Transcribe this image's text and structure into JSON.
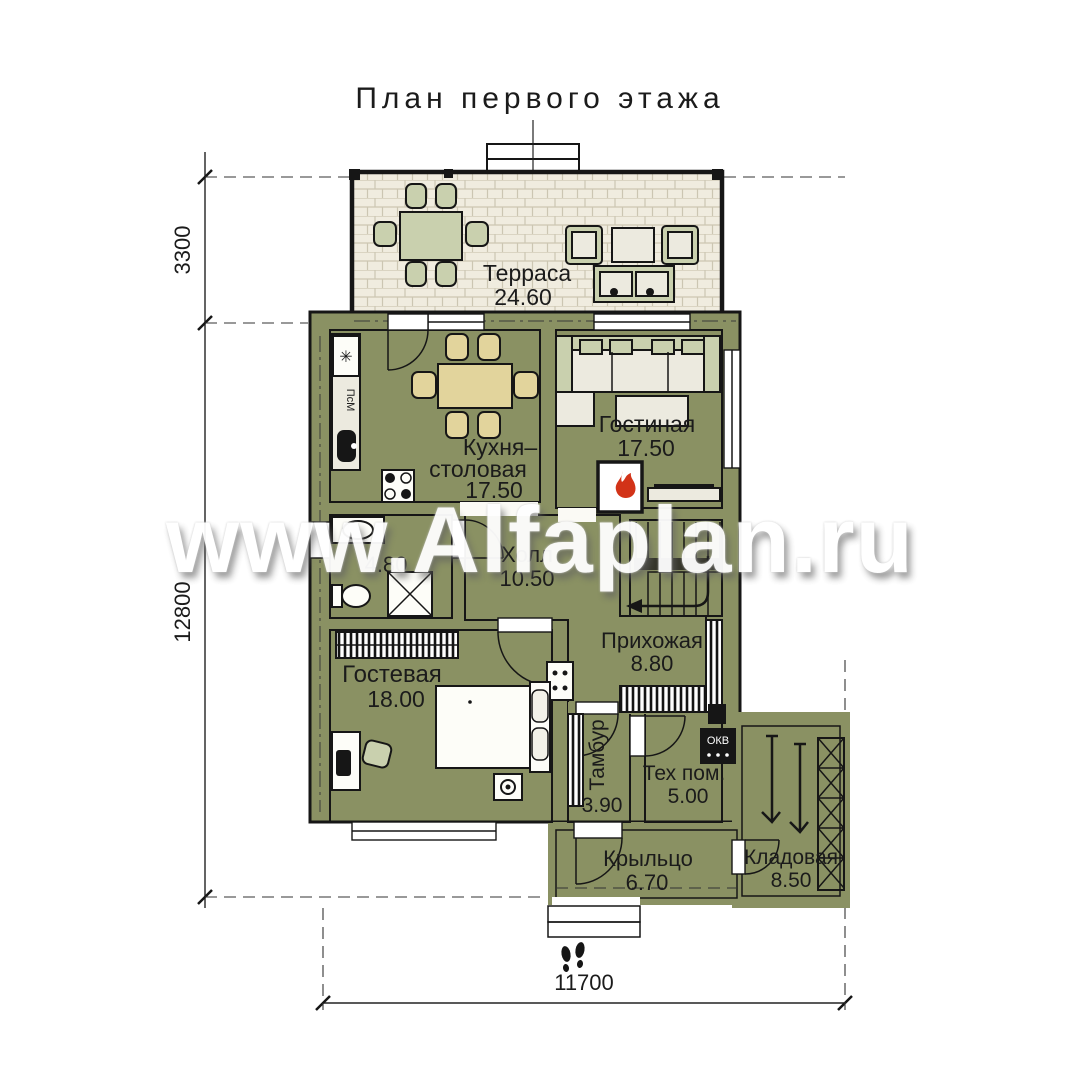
{
  "title": "План первого этажа",
  "watermark": "www.Alfaplan.ru",
  "dimensions": {
    "terrace_depth": "3300",
    "house_depth": "12800",
    "house_width": "11700"
  },
  "rooms": {
    "terrace": {
      "name": "Терраса",
      "area": "24.60"
    },
    "kitchen": {
      "name1": "Кухня–",
      "name2": "столовая",
      "area": "17.50"
    },
    "living": {
      "name": "Гостиная",
      "area": "17.50"
    },
    "bathroom": {
      "area": "4.80"
    },
    "hall": {
      "name": "Холл",
      "area": "10.50"
    },
    "hallway": {
      "name": "Прихожая",
      "area": "8.80"
    },
    "guest": {
      "name": "Гостевая",
      "area": "18.00"
    },
    "tambour": {
      "name": "Тамбур",
      "area": "3.90"
    },
    "tech": {
      "name": "Тех пом.",
      "area": "5.00"
    },
    "porch": {
      "name": "Крыльцо",
      "area": "6.70"
    },
    "storage": {
      "name": "Кладовая",
      "area": "8.50"
    }
  },
  "equipment": {
    "fridge_mark": "✳",
    "dishwasher": "ПсМ",
    "boiler": "ОКВ"
  },
  "colors": {
    "wall": "#8a9163",
    "flame": "#d23318",
    "sage": "#c9d0ae",
    "tan": "#e2d49c",
    "step": "#e2ecd4",
    "kitchen_floor": "#f3eabf",
    "tile": "#d6e6e8"
  }
}
